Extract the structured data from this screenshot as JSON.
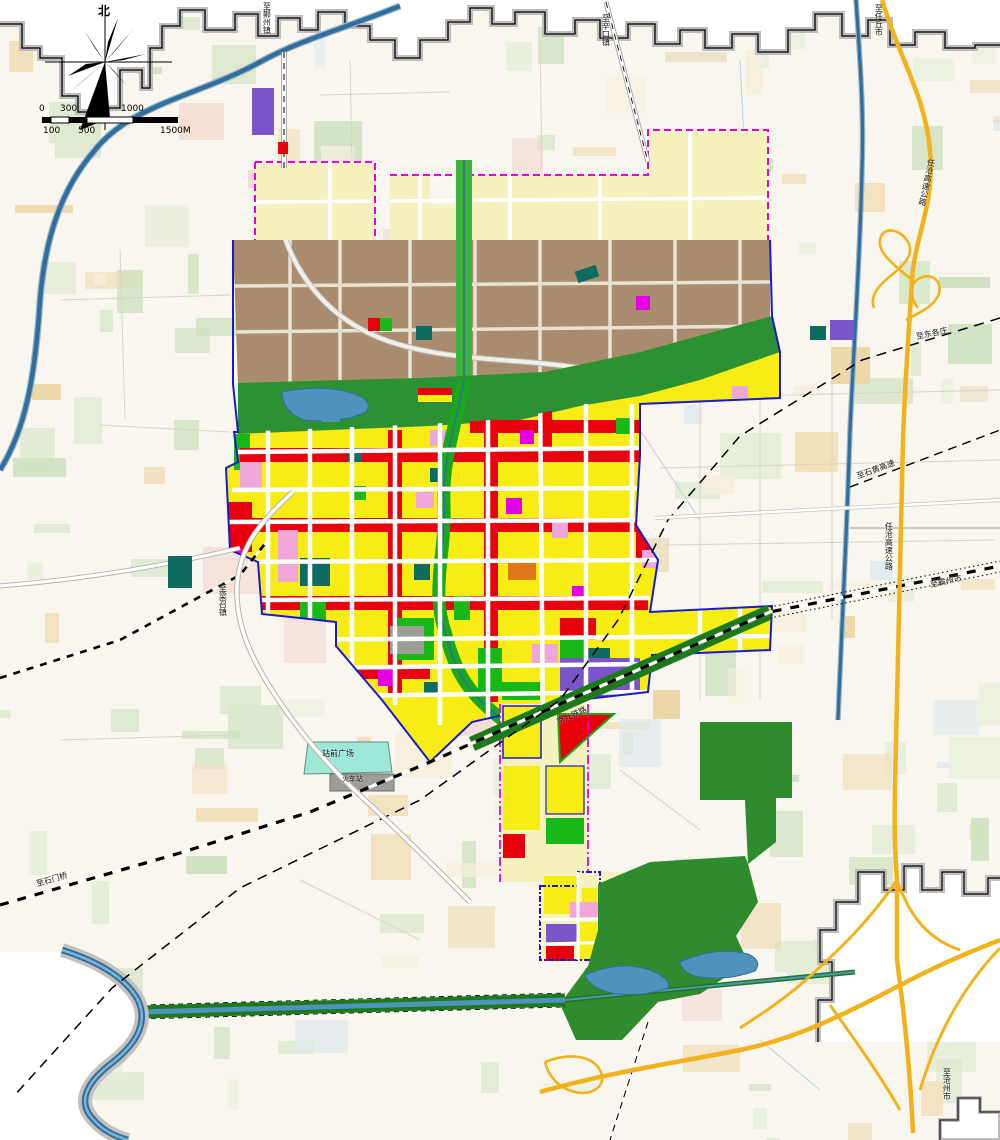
{
  "compass": {
    "north_label": "北"
  },
  "scalebar": {
    "top_ticks": [
      "0",
      "300",
      "1000"
    ],
    "bottom_ticks": [
      "100",
      "500",
      "1500M"
    ]
  },
  "labels": {
    "to_mozhou": "至鄚州镇",
    "to_xinkou": "至辛口镇",
    "to_renqiu": "至任丘市",
    "expressway_north": "任沧高速公路",
    "expressway_south": "任沧高速公路",
    "to_shihuang": "至石黄高速",
    "to_bazhou": "至霸州市",
    "to_donggezhuang": "至东各庄",
    "to_shimenqiao": "至石门桥",
    "to_cangzhou": "至沧州市",
    "to_liangzhao": "至梁召镇",
    "station_plaza": "站前广场",
    "railway_station": "火车站",
    "railway": "京九铁路"
  },
  "palette": {
    "residential": "#f7ec13",
    "commercial": "#e8000d",
    "industrial": "#a98b6e",
    "planned": "#f5f2c0",
    "park": "#17b817",
    "belt": "#2c9132",
    "forest": "#2e8b2e",
    "corridor": "#1c7a1c",
    "water": "#4f93bd",
    "water_dark": "#2f6f9f",
    "expressway": "#f2b21c",
    "purple": "#7a55c8",
    "pink": "#efa6d8",
    "magenta": "#e400e4",
    "teal": "#0e6b62",
    "orange": "#e07818",
    "gray_parcel": "#9c9c98",
    "aqua": "#9fe8d8",
    "city_boundary": "#1a1acc",
    "plan_boundary": "#e400e4",
    "outside": "#ffffff"
  }
}
